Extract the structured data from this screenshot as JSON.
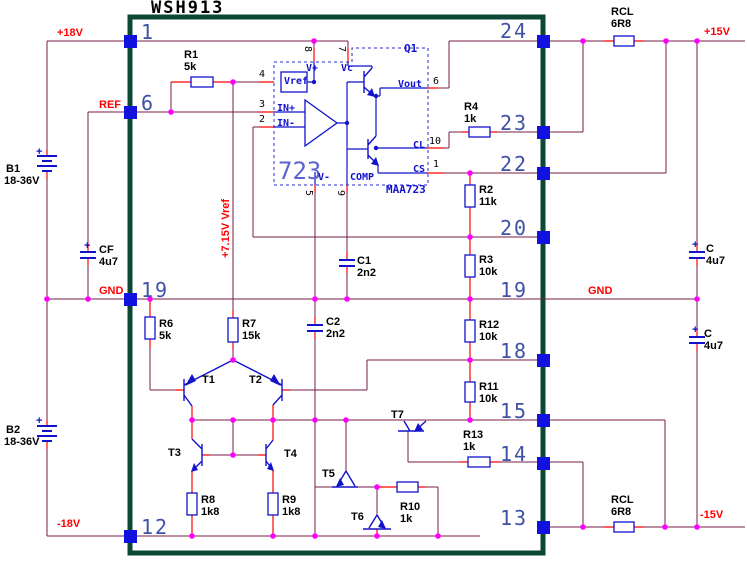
{
  "title": {
    "text": "WSH913"
  },
  "palette": {
    "wire": "#7a1c48",
    "lead": "#ff0000",
    "symbol_blue": "#1212cc",
    "pad_blue": "#1212e0",
    "junction_pink": "#ff00ff",
    "module_border": "#0d4736",
    "pin_number": "#3f51a5",
    "net_label": "#ff0000",
    "ic_accent": "#5a64cc",
    "background": "#ffffff"
  },
  "module": {
    "name": "WSH913",
    "regulator_ic": {
      "label": "723",
      "part": "MAA723",
      "pass_transistor": "Q1"
    },
    "left_pins": [
      "1",
      "6",
      "19",
      "12"
    ],
    "right_pins": [
      "24",
      "23",
      "22",
      "20",
      "19",
      "18",
      "15",
      "14",
      "13"
    ]
  },
  "labels": [
    {
      "id": "net-plus18v",
      "group": "net",
      "text": "+18V",
      "cls": "net",
      "x": 57,
      "y": 28
    },
    {
      "id": "net-ref",
      "group": "net",
      "text": "REF",
      "cls": "net",
      "x": 99,
      "y": 100
    },
    {
      "id": "net-gnd-left",
      "group": "net",
      "text": "GND",
      "cls": "net",
      "x": 99,
      "y": 286
    },
    {
      "id": "net-minus18v",
      "group": "net",
      "text": "-18V",
      "cls": "net",
      "x": 57,
      "y": 519
    },
    {
      "id": "net-plus15v",
      "group": "net",
      "text": "+15V",
      "cls": "net",
      "x": 704,
      "y": 27
    },
    {
      "id": "net-gnd-right",
      "group": "net",
      "text": "GND",
      "cls": "net",
      "x": 588,
      "y": 286
    },
    {
      "id": "net-minus15v",
      "group": "net",
      "text": "-15V",
      "cls": "net",
      "x": 700,
      "y": 510
    },
    {
      "id": "net-vref-7v15",
      "group": "net",
      "text": "+7.15V Vref",
      "cls": "net",
      "x": 221,
      "y": 258,
      "rot": "ccw"
    },
    {
      "id": "pin-1",
      "group": "pin",
      "text": "1",
      "cls": "pin",
      "x": 141,
      "y": 22
    },
    {
      "id": "pin-6",
      "group": "pin",
      "text": "6",
      "cls": "pin",
      "x": 141,
      "y": 93
    },
    {
      "id": "pin-19-left",
      "group": "pin",
      "text": "19",
      "cls": "pin",
      "x": 141,
      "y": 280
    },
    {
      "id": "pin-12",
      "group": "pin",
      "text": "12",
      "cls": "pin",
      "x": 141,
      "y": 517
    },
    {
      "id": "pin-24",
      "group": "pin",
      "text": "24",
      "cls": "pin",
      "x": 500,
      "y": 21
    },
    {
      "id": "pin-23",
      "group": "pin",
      "text": "23",
      "cls": "pin",
      "x": 500,
      "y": 113
    },
    {
      "id": "pin-22",
      "group": "pin",
      "text": "22",
      "cls": "pin",
      "x": 500,
      "y": 154
    },
    {
      "id": "pin-20",
      "group": "pin",
      "text": "20",
      "cls": "pin",
      "x": 500,
      "y": 218
    },
    {
      "id": "pin-19-right",
      "group": "pin",
      "text": "19",
      "cls": "pin",
      "x": 500,
      "y": 280
    },
    {
      "id": "pin-18",
      "group": "pin",
      "text": "18",
      "cls": "pin",
      "x": 500,
      "y": 341
    },
    {
      "id": "pin-15",
      "group": "pin",
      "text": "15",
      "cls": "pin",
      "x": 500,
      "y": 401
    },
    {
      "id": "pin-14",
      "group": "pin",
      "text": "14",
      "cls": "pin",
      "x": 500,
      "y": 444
    },
    {
      "id": "pin-13",
      "group": "pin",
      "text": "13",
      "cls": "pin",
      "x": 500,
      "y": 508
    },
    {
      "id": "r1-ref",
      "group": "component",
      "text": "R1",
      "cls": "comp",
      "x": 184,
      "y": 50
    },
    {
      "id": "r1-val",
      "group": "component",
      "text": "5k",
      "cls": "comp",
      "x": 184,
      "y": 62
    },
    {
      "id": "r4-ref",
      "group": "component",
      "text": "R4",
      "cls": "comp",
      "x": 464,
      "y": 102
    },
    {
      "id": "r4-val",
      "group": "component",
      "text": "1k",
      "cls": "comp",
      "x": 464,
      "y": 114
    },
    {
      "id": "rcl-top-ref",
      "group": "component",
      "text": "RCL",
      "cls": "comp",
      "x": 611,
      "y": 7
    },
    {
      "id": "rcl-top-val",
      "group": "component",
      "text": "6R8",
      "cls": "comp",
      "x": 611,
      "y": 19
    },
    {
      "id": "rcl-bot-ref",
      "group": "component",
      "text": "RCL",
      "cls": "comp",
      "x": 611,
      "y": 495
    },
    {
      "id": "rcl-bot-val",
      "group": "component",
      "text": "6R8",
      "cls": "comp",
      "x": 611,
      "y": 507
    },
    {
      "id": "r2-ref",
      "group": "component",
      "text": "R2",
      "cls": "comp",
      "x": 479,
      "y": 185
    },
    {
      "id": "r2-val",
      "group": "component",
      "text": "11k",
      "cls": "comp",
      "x": 479,
      "y": 197
    },
    {
      "id": "r3-ref",
      "group": "component",
      "text": "R3",
      "cls": "comp",
      "x": 479,
      "y": 255
    },
    {
      "id": "r3-val",
      "group": "component",
      "text": "10k",
      "cls": "comp",
      "x": 479,
      "y": 267
    },
    {
      "id": "r12-ref",
      "group": "component",
      "text": "R12",
      "cls": "comp",
      "x": 479,
      "y": 320
    },
    {
      "id": "r12-val",
      "group": "component",
      "text": "10k",
      "cls": "comp",
      "x": 479,
      "y": 332
    },
    {
      "id": "r11-ref",
      "group": "component",
      "text": "R11",
      "cls": "comp",
      "x": 479,
      "y": 382
    },
    {
      "id": "r11-val",
      "group": "component",
      "text": "10k",
      "cls": "comp",
      "x": 479,
      "y": 394
    },
    {
      "id": "r13-ref",
      "group": "component",
      "text": "R13",
      "cls": "comp",
      "x": 463,
      "y": 430
    },
    {
      "id": "r13-val",
      "group": "component",
      "text": "1k",
      "cls": "comp",
      "x": 463,
      "y": 442
    },
    {
      "id": "r6-ref",
      "group": "component",
      "text": "R6",
      "cls": "comp",
      "x": 159,
      "y": 319
    },
    {
      "id": "r6-val",
      "group": "component",
      "text": "5k",
      "cls": "comp",
      "x": 159,
      "y": 331
    },
    {
      "id": "r7-ref",
      "group": "component",
      "text": "R7",
      "cls": "comp",
      "x": 242,
      "y": 319
    },
    {
      "id": "r7-val",
      "group": "component",
      "text": "15k",
      "cls": "comp",
      "x": 242,
      "y": 331
    },
    {
      "id": "r8-ref",
      "group": "component",
      "text": "R8",
      "cls": "comp",
      "x": 201,
      "y": 495
    },
    {
      "id": "r8-val",
      "group": "component",
      "text": "1k8",
      "cls": "comp",
      "x": 201,
      "y": 507
    },
    {
      "id": "r9-ref",
      "group": "component",
      "text": "R9",
      "cls": "comp",
      "x": 282,
      "y": 495
    },
    {
      "id": "r9-val",
      "group": "component",
      "text": "1k8",
      "cls": "comp",
      "x": 282,
      "y": 507
    },
    {
      "id": "r10-ref",
      "group": "component",
      "text": "R10",
      "cls": "comp",
      "x": 400,
      "y": 502
    },
    {
      "id": "r10-val",
      "group": "component",
      "text": "1k",
      "cls": "comp",
      "x": 400,
      "y": 514
    },
    {
      "id": "c1-ref",
      "group": "component",
      "text": "C1",
      "cls": "comp",
      "x": 357,
      "y": 256
    },
    {
      "id": "c1-val",
      "group": "component",
      "text": "2n2",
      "cls": "comp",
      "x": 357,
      "y": 268
    },
    {
      "id": "c2-ref",
      "group": "component",
      "text": "C2",
      "cls": "comp",
      "x": 326,
      "y": 317
    },
    {
      "id": "c2-val",
      "group": "component",
      "text": "2n2",
      "cls": "comp",
      "x": 326,
      "y": 329
    },
    {
      "id": "cf-ref",
      "group": "component",
      "text": "CF",
      "cls": "comp",
      "x": 99,
      "y": 245
    },
    {
      "id": "cf-val",
      "group": "component",
      "text": "4u7",
      "cls": "comp",
      "x": 99,
      "y": 257
    },
    {
      "id": "c-top-ref",
      "group": "component",
      "text": "C",
      "cls": "comp",
      "x": 706,
      "y": 244
    },
    {
      "id": "c-top-val",
      "group": "component",
      "text": "4u7",
      "cls": "comp",
      "x": 706,
      "y": 256
    },
    {
      "id": "c-bot-ref",
      "group": "component",
      "text": "C",
      "cls": "comp",
      "x": 704,
      "y": 329
    },
    {
      "id": "c-bot-val",
      "group": "component",
      "text": "4u7",
      "cls": "comp",
      "x": 704,
      "y": 341
    },
    {
      "id": "b1-ref",
      "group": "component",
      "text": "B1",
      "cls": "comp",
      "x": 6,
      "y": 164
    },
    {
      "id": "b1-val",
      "group": "component",
      "text": "18-36V",
      "cls": "comp",
      "x": 4,
      "y": 176
    },
    {
      "id": "b2-ref",
      "group": "component",
      "text": "B2",
      "cls": "comp",
      "x": 6,
      "y": 425
    },
    {
      "id": "b2-val",
      "group": "component",
      "text": "18-36V",
      "cls": "comp",
      "x": 4,
      "y": 437
    },
    {
      "id": "t1-ref",
      "group": "component",
      "text": "T1",
      "cls": "comp",
      "x": 202,
      "y": 375
    },
    {
      "id": "t2-ref",
      "group": "component",
      "text": "T2",
      "cls": "comp",
      "x": 249,
      "y": 375
    },
    {
      "id": "t3-ref",
      "group": "component",
      "text": "T3",
      "cls": "comp",
      "x": 168,
      "y": 448
    },
    {
      "id": "t4-ref",
      "group": "component",
      "text": "T4",
      "cls": "comp",
      "x": 284,
      "y": 449
    },
    {
      "id": "t5-ref",
      "group": "component",
      "text": "T5",
      "cls": "comp",
      "x": 322,
      "y": 469
    },
    {
      "id": "t6-ref",
      "group": "component",
      "text": "T6",
      "cls": "comp",
      "x": 351,
      "y": 512
    },
    {
      "id": "t7-ref",
      "group": "component",
      "text": "T7",
      "cls": "comp",
      "x": 391,
      "y": 410
    },
    {
      "id": "b1-plus",
      "group": "polarity",
      "text": "+",
      "cls": "plus",
      "x": 36,
      "y": 147
    },
    {
      "id": "b2-plus",
      "group": "polarity",
      "text": "+",
      "cls": "plus",
      "x": 36,
      "y": 416
    },
    {
      "id": "cf-plus",
      "group": "polarity",
      "text": "+",
      "cls": "plus",
      "x": 84,
      "y": 241
    },
    {
      "id": "c-top-plus",
      "group": "polarity",
      "text": "+",
      "cls": "plus",
      "x": 692,
      "y": 240
    },
    {
      "id": "c-bot-plus",
      "group": "polarity",
      "text": "+",
      "cls": "plus",
      "x": 692,
      "y": 325
    },
    {
      "id": "ic-723",
      "group": "ic",
      "text": "723",
      "cls": "icbig",
      "x": 278,
      "y": 159
    },
    {
      "id": "ic-part",
      "group": "ic",
      "text": "MAA723",
      "cls": "icpart",
      "x": 386,
      "y": 184
    },
    {
      "id": "ic-q1",
      "group": "ic",
      "text": "Q1",
      "cls": "icpart",
      "x": 404,
      "y": 43
    },
    {
      "id": "ic-vref",
      "group": "ic",
      "text": "Vref",
      "cls": "icname",
      "x": 284,
      "y": 77
    },
    {
      "id": "ic-vplus",
      "group": "ic",
      "text": "V+",
      "cls": "icname",
      "x": 306,
      "y": 64
    },
    {
      "id": "ic-vc",
      "group": "ic",
      "text": "Vc",
      "cls": "icname",
      "x": 341,
      "y": 64
    },
    {
      "id": "ic-inplus",
      "group": "ic",
      "text": "IN+",
      "cls": "icname",
      "x": 277,
      "y": 104
    },
    {
      "id": "ic-inminus",
      "group": "ic",
      "text": "IN-",
      "cls": "icname",
      "x": 277,
      "y": 119
    },
    {
      "id": "ic-vout",
      "group": "ic",
      "text": "Vout",
      "cls": "icname",
      "x": 398,
      "y": 80
    },
    {
      "id": "ic-cl",
      "group": "ic",
      "text": "CL",
      "cls": "icname",
      "x": 413,
      "y": 141
    },
    {
      "id": "ic-cs",
      "group": "ic",
      "text": "CS",
      "cls": "icname",
      "x": 413,
      "y": 165
    },
    {
      "id": "ic-vminus",
      "group": "ic",
      "text": "V-",
      "cls": "icname",
      "x": 318,
      "y": 173
    },
    {
      "id": "ic-comp",
      "group": "ic",
      "text": "COMP",
      "cls": "icname",
      "x": 350,
      "y": 173
    },
    {
      "id": "icpin-4",
      "group": "ic",
      "text": "4",
      "cls": "icnum",
      "x": 259,
      "y": 70
    },
    {
      "id": "icpin-3",
      "group": "ic",
      "text": "3",
      "cls": "icnum",
      "x": 259,
      "y": 100
    },
    {
      "id": "icpin-2",
      "group": "ic",
      "text": "2",
      "cls": "icnum",
      "x": 259,
      "y": 115
    },
    {
      "id": "icpin-6",
      "group": "ic",
      "text": "6",
      "cls": "icnum",
      "x": 433,
      "y": 77
    },
    {
      "id": "icpin-10",
      "group": "ic",
      "text": "10",
      "cls": "icnum",
      "x": 429,
      "y": 137
    },
    {
      "id": "icpin-1",
      "group": "ic",
      "text": "1",
      "cls": "icnum",
      "x": 433,
      "y": 160
    },
    {
      "id": "icpin-8",
      "group": "ic",
      "text": "8",
      "cls": "icnum",
      "x": 312,
      "y": 46,
      "rot": "cw"
    },
    {
      "id": "icpin-7",
      "group": "ic",
      "text": "7",
      "cls": "icnum",
      "x": 346,
      "y": 46,
      "rot": "cw"
    },
    {
      "id": "icpin-5",
      "group": "ic",
      "text": "5",
      "cls": "icnum",
      "x": 313,
      "y": 190,
      "rot": "cw"
    },
    {
      "id": "icpin-9",
      "group": "ic",
      "text": "9",
      "cls": "icnum",
      "x": 345,
      "y": 190,
      "rot": "cw"
    }
  ]
}
